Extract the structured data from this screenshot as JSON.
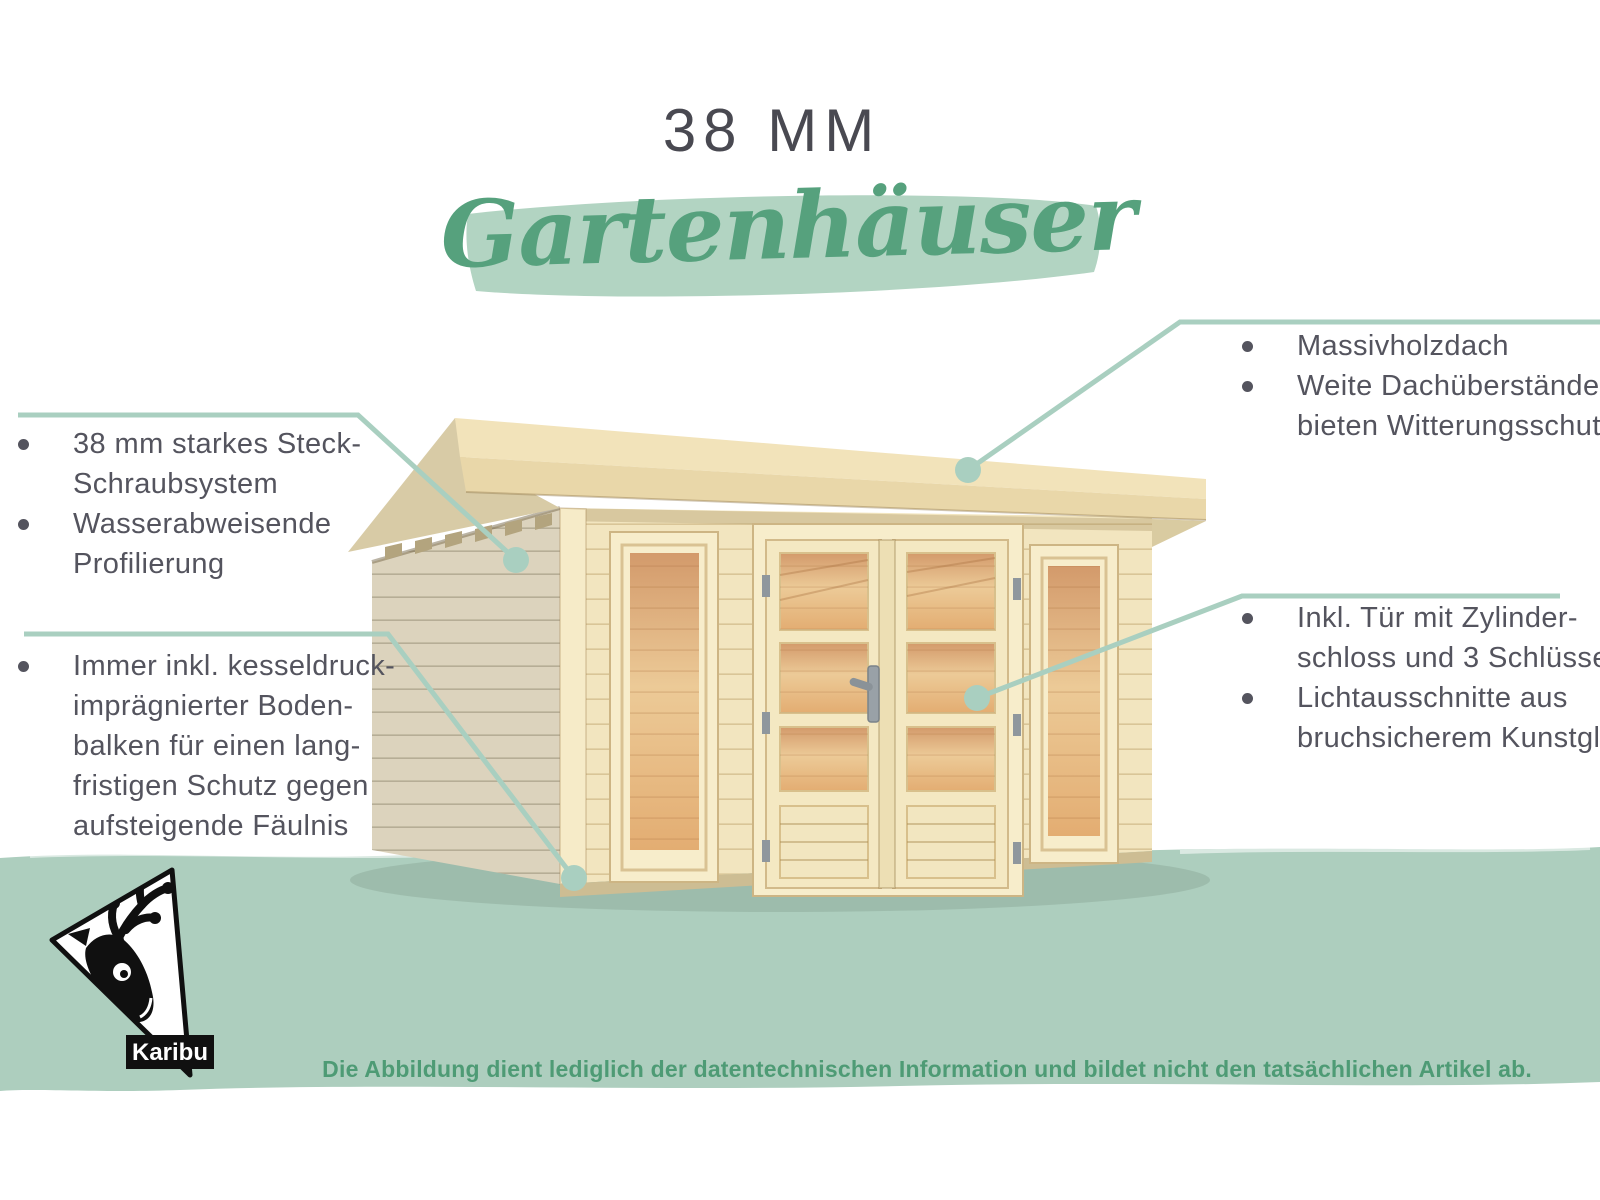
{
  "page": {
    "title": "38 MM",
    "subtitle": "Gartenhäuser"
  },
  "callouts": {
    "left_top": {
      "items": [
        {
          "lines": [
            "38 mm starkes Steck-",
            "Schraubsystem"
          ]
        },
        {
          "lines": [
            "Wasserabweisende",
            "Profilierung"
          ]
        }
      ]
    },
    "left_bottom": {
      "items": [
        {
          "lines": [
            "Immer inkl. kesseldruck-",
            "imprägnierter Boden-",
            "balken für einen lang-",
            "fristigen Schutz gegen",
            "aufsteigende Fäulnis"
          ]
        }
      ]
    },
    "top_right": {
      "items": [
        {
          "lines": [
            "Massivholzdach"
          ]
        },
        {
          "lines": [
            "Weite Dachüberstände",
            "bieten Witterungsschutz"
          ]
        }
      ]
    },
    "right_bottom": {
      "items": [
        {
          "lines": [
            "Inkl. Tür mit Zylinder-",
            "schloss und 3 Schlüsseln"
          ]
        },
        {
          "lines": [
            "Lichtausschnitte aus",
            "bruchsicherem Kunstglas"
          ]
        }
      ]
    }
  },
  "footer": {
    "disclaimer": "Die Abbildung dient lediglich der datentechnischen Information und bildet nicht den tatsächlichen Artikel ab."
  },
  "logo": {
    "brand": "Karibu"
  },
  "colors": {
    "accent_green": "#56a17d",
    "callout_line_green": "#a9cfc0",
    "brush_green": "#b2d4c2",
    "band_green": "#adcebe",
    "text_gray": "#54545e",
    "title_gray": "#494951",
    "disclaimer_green": "#4e9b75",
    "wood_front": "#f2e5bf",
    "wood_side": "#dcd3bd",
    "wood_roof": "#f2e3ba",
    "interior_warm": "#e0a874"
  }
}
